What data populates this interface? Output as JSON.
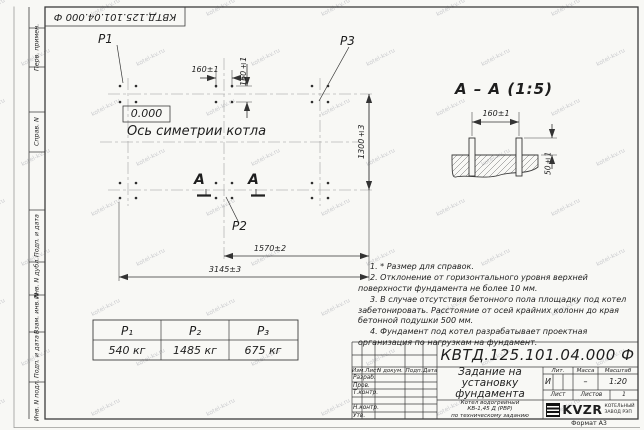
{
  "sheet": {
    "doc_number_rotated": "КВТД.125.101.04.000 Ф",
    "format_label": "Формат А3"
  },
  "frame_left_fields": [
    "Перв. примен.",
    "Справ. N",
    "Подп. и дата",
    "Инв. N дубл.",
    "Взам. инв. N",
    "Подп. и дата",
    "Инв. N подл."
  ],
  "plan": {
    "p1": "P1",
    "p2": "P2",
    "p3": "P3",
    "level_mark": "0.000",
    "axis_label": "Ось симетрии котла",
    "section_letter_left": "А",
    "section_letter_right": "А",
    "dim_pitch_h": "160±1",
    "dim_pitch_v": "160±1",
    "dim_width": "1300±3",
    "dim_half_length": "1570±2",
    "dim_length": "3145±3"
  },
  "section_view": {
    "title": "А – А (1:5)",
    "dim_pitch": "160±1",
    "dim_height": "50±1"
  },
  "notes": [
    "1. * Размер для справок.",
    "2. Отклонение от горизонтального уровня верхней поверхности фундамента не более 10 мм.",
    "3. В случае отсутствия бетонного пола площадку под котел забетонировать. Расстояние от осей крайних колонн до края бетонной подушки 500 мм.",
    "4. Фундамент под котел разрабатывает проектная организация по нагрузкам на фундамент."
  ],
  "load_table": {
    "headers": [
      "P₁",
      "P₂",
      "P₃"
    ],
    "values": [
      "540 кг",
      "1485 кг",
      "675 кг"
    ]
  },
  "title_block": {
    "doc_number": "КВТД.125.101.04.000 Ф",
    "title": "Задание на установку фундамента",
    "subtitle_lines": [
      "Котел водогрейный",
      "КВ-1,45 Д (РВР)",
      "по техническому заданию"
    ],
    "col_izm": "Изм.Лист",
    "col_doc": "N докум.",
    "col_sign": "Подп.",
    "col_date": "Дата",
    "row_developer": "Разраб.",
    "row_checker": "Пров.",
    "row_tcontrol": "Т.контр.",
    "row_ncontrol": "Н.контр.",
    "row_approved": "Утв.",
    "lit_label": "Лит.",
    "mass_label": "Масса",
    "scale_label": "Масштаб",
    "lit_value": "И",
    "mass_value": "–",
    "scale_value": "1:20",
    "sheet_label": "Лист",
    "sheets_label": "Листов",
    "sheets_value": "1",
    "logo_text": "KVZR",
    "company_line1": "КОТЕЛЬНЫЙ",
    "company_line2": "ЗАВОД РЭП"
  },
  "watermark_text": "kotel-kv.ru"
}
